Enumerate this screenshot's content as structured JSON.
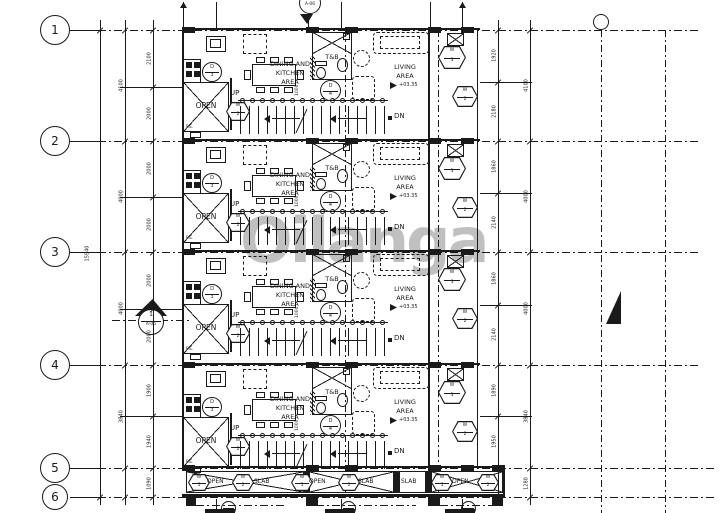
{
  "watermark": "Oilanga",
  "grid_rows": [
    "1",
    "2",
    "3",
    "4",
    "5",
    "6"
  ],
  "section_markers": {
    "top_sheet": "A-06",
    "left_number": "1",
    "left_sheet": "A-05"
  },
  "dims": {
    "overall_left": "15940",
    "left_units": [
      {
        "splits": [
          "2100",
          "2000"
        ],
        "total": "4100"
      },
      {
        "splits": [
          "2000",
          "2000"
        ],
        "total": "4000"
      },
      {
        "splits": [
          "2000",
          "2000"
        ],
        "total": "4000"
      },
      {
        "splits": [
          "1900",
          "1940"
        ],
        "total": "3840"
      }
    ],
    "right_units": [
      {
        "splits": [
          "1920",
          "2180"
        ],
        "total": "4100"
      },
      {
        "splits": [
          "1860",
          "2140"
        ],
        "total": "4000"
      },
      {
        "splits": [
          "1860",
          "2140"
        ],
        "total": "4000"
      },
      {
        "splits": [
          "1890",
          "1950"
        ],
        "total": "3840"
      }
    ],
    "left_bottom": "1090",
    "right_bottom": "1280",
    "stair_width": "1000"
  },
  "unit_labels": {
    "dining": [
      "DINING AND",
      "KITCHEN",
      "AREA"
    ],
    "living": [
      "LIVING",
      "AREA"
    ],
    "elevation": "+03.35",
    "toilet": "T&B",
    "open": "OPEN",
    "fire_exit": "F.E.",
    "up": "UP",
    "down": "DN",
    "door_kitchen": [
      "D",
      "3"
    ],
    "door_living": [
      "D",
      "4"
    ],
    "window_stair": [
      "W",
      "2"
    ],
    "window_balcony_top": [
      "W",
      "3"
    ],
    "window_balcony_bottom": [
      "W",
      "2"
    ]
  },
  "bottom_strip": {
    "bays": [
      {
        "items": [
          {
            "t": "hex",
            "v": [
              "W",
              "5"
            ]
          },
          {
            "t": "text",
            "v": "OPEN"
          },
          {
            "t": "hex",
            "v": [
              "W",
              "2"
            ]
          },
          {
            "t": "text",
            "v": "SLAB"
          }
        ]
      },
      {
        "items": [
          {
            "t": "hex",
            "v": [
              "W",
              "5"
            ]
          },
          {
            "t": "text",
            "v": "OPEN"
          },
          {
            "t": "hex",
            "v": [
              "W",
              "2"
            ]
          },
          {
            "t": "text",
            "v": "SLAB"
          }
        ]
      },
      {
        "items": [
          {
            "t": "text",
            "v": "SLAB"
          },
          {
            "t": "hex",
            "v": [
              "W",
              "5"
            ]
          },
          {
            "t": "text",
            "v": "OPEN"
          },
          {
            "t": "hex",
            "v": [
              "W",
              "2"
            ]
          }
        ]
      }
    ]
  }
}
